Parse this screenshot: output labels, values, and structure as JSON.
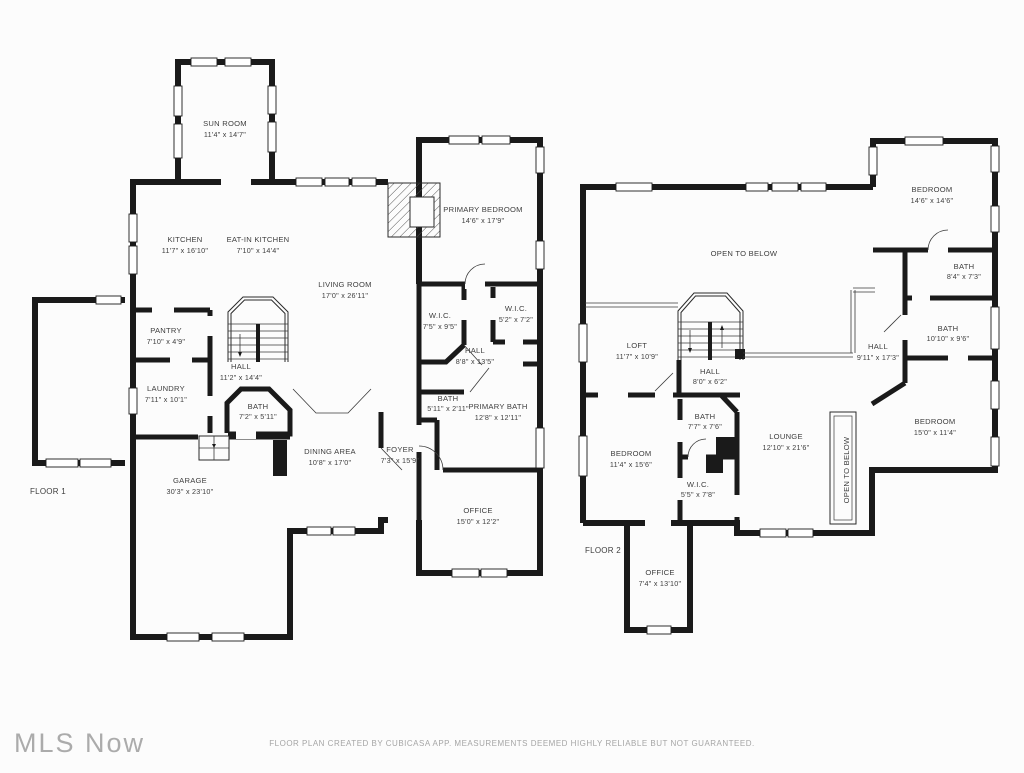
{
  "meta": {
    "watermark": "MLS Now",
    "disclaimer": "FLOOR PLAN CREATED BY CUBICASA APP. MEASUREMENTS DEEMED HIGHLY RELIABLE BUT NOT GUARANTEED."
  },
  "colors": {
    "wall": "#1a1a1a",
    "room_text": "#3e3e3e",
    "watermark_text": "#ababab",
    "disclaimer_text": "#a5a5a5",
    "background": "#fcfcfc"
  },
  "floor1": {
    "label": "FLOOR 1",
    "rooms": [
      {
        "id": "sun-room",
        "name": "SUN ROOM",
        "dims": "11'4\" x 14'7\""
      },
      {
        "id": "kitchen",
        "name": "KITCHEN",
        "dims": "11'7\" x 16'10\""
      },
      {
        "id": "eat-in-kitchen",
        "name": "EAT-IN KITCHEN",
        "dims": "7'10\" x 14'4\""
      },
      {
        "id": "living-room",
        "name": "LIVING ROOM",
        "dims": "17'0\" x 26'11\""
      },
      {
        "id": "primary-bedroom",
        "name": "PRIMARY BEDROOM",
        "dims": "14'6\" x 17'9\""
      },
      {
        "id": "wic-1",
        "name": "W.I.C.",
        "dims": "7'5\" x 9'5\""
      },
      {
        "id": "wic-2",
        "name": "W.I.C.",
        "dims": "5'2\" x 7'2\""
      },
      {
        "id": "hall-upper",
        "name": "HALL",
        "dims": "8'8\" x 13'5\""
      },
      {
        "id": "bath-hall",
        "name": "BATH",
        "dims": "5'11\" x 2'11\""
      },
      {
        "id": "primary-bath",
        "name": "PRIMARY BATH",
        "dims": "12'8\" x 12'11\""
      },
      {
        "id": "pantry",
        "name": "PANTRY",
        "dims": "7'10\" x 4'9\""
      },
      {
        "id": "laundry",
        "name": "LAUNDRY",
        "dims": "7'11\" x 10'1\""
      },
      {
        "id": "hall-stairs",
        "name": "HALL",
        "dims": "11'2\" x 14'4\""
      },
      {
        "id": "bath-main",
        "name": "BATH",
        "dims": "7'2\" x 5'11\""
      },
      {
        "id": "dining-area",
        "name": "DINING AREA",
        "dims": "10'8\" x 17'0\""
      },
      {
        "id": "foyer",
        "name": "FOYER",
        "dims": "7'3\" x 15'9\""
      },
      {
        "id": "garage",
        "name": "GARAGE",
        "dims": "30'3\" x 23'10\""
      },
      {
        "id": "office",
        "name": "OFFICE",
        "dims": "15'0\" x 12'2\""
      }
    ]
  },
  "floor2": {
    "label": "FLOOR 2",
    "rooms": [
      {
        "id": "open-to-below",
        "name": "OPEN TO BELOW"
      },
      {
        "id": "loft",
        "name": "LOFT",
        "dims": "11'7\" x 10'9\""
      },
      {
        "id": "hall-stairs",
        "name": "HALL",
        "dims": "8'0\" x 6'2\""
      },
      {
        "id": "hall",
        "name": "HALL",
        "dims": "9'11\" x 17'3\""
      },
      {
        "id": "bedroom-1",
        "name": "BEDROOM",
        "dims": "14'6\" x 14'6\""
      },
      {
        "id": "bath-1",
        "name": "BATH",
        "dims": "8'4\" x 7'3\""
      },
      {
        "id": "bath-2",
        "name": "BATH",
        "dims": "10'10\" x 9'6\""
      },
      {
        "id": "bedroom-2",
        "name": "BEDROOM",
        "dims": "15'0\" x 11'4\""
      },
      {
        "id": "lounge",
        "name": "LOUNGE",
        "dims": "12'10\" x 21'6\""
      },
      {
        "id": "open-to-below-side",
        "name": "OPEN TO BELOW"
      },
      {
        "id": "bedroom-3",
        "name": "BEDROOM",
        "dims": "11'4\" x 15'6\""
      },
      {
        "id": "bath-3",
        "name": "BATH",
        "dims": "7'7\" x 7'6\""
      },
      {
        "id": "wic",
        "name": "W.I.C.",
        "dims": "5'5\" x 7'8\""
      },
      {
        "id": "office",
        "name": "OFFICE",
        "dims": "7'4\" x 13'10\""
      }
    ]
  }
}
